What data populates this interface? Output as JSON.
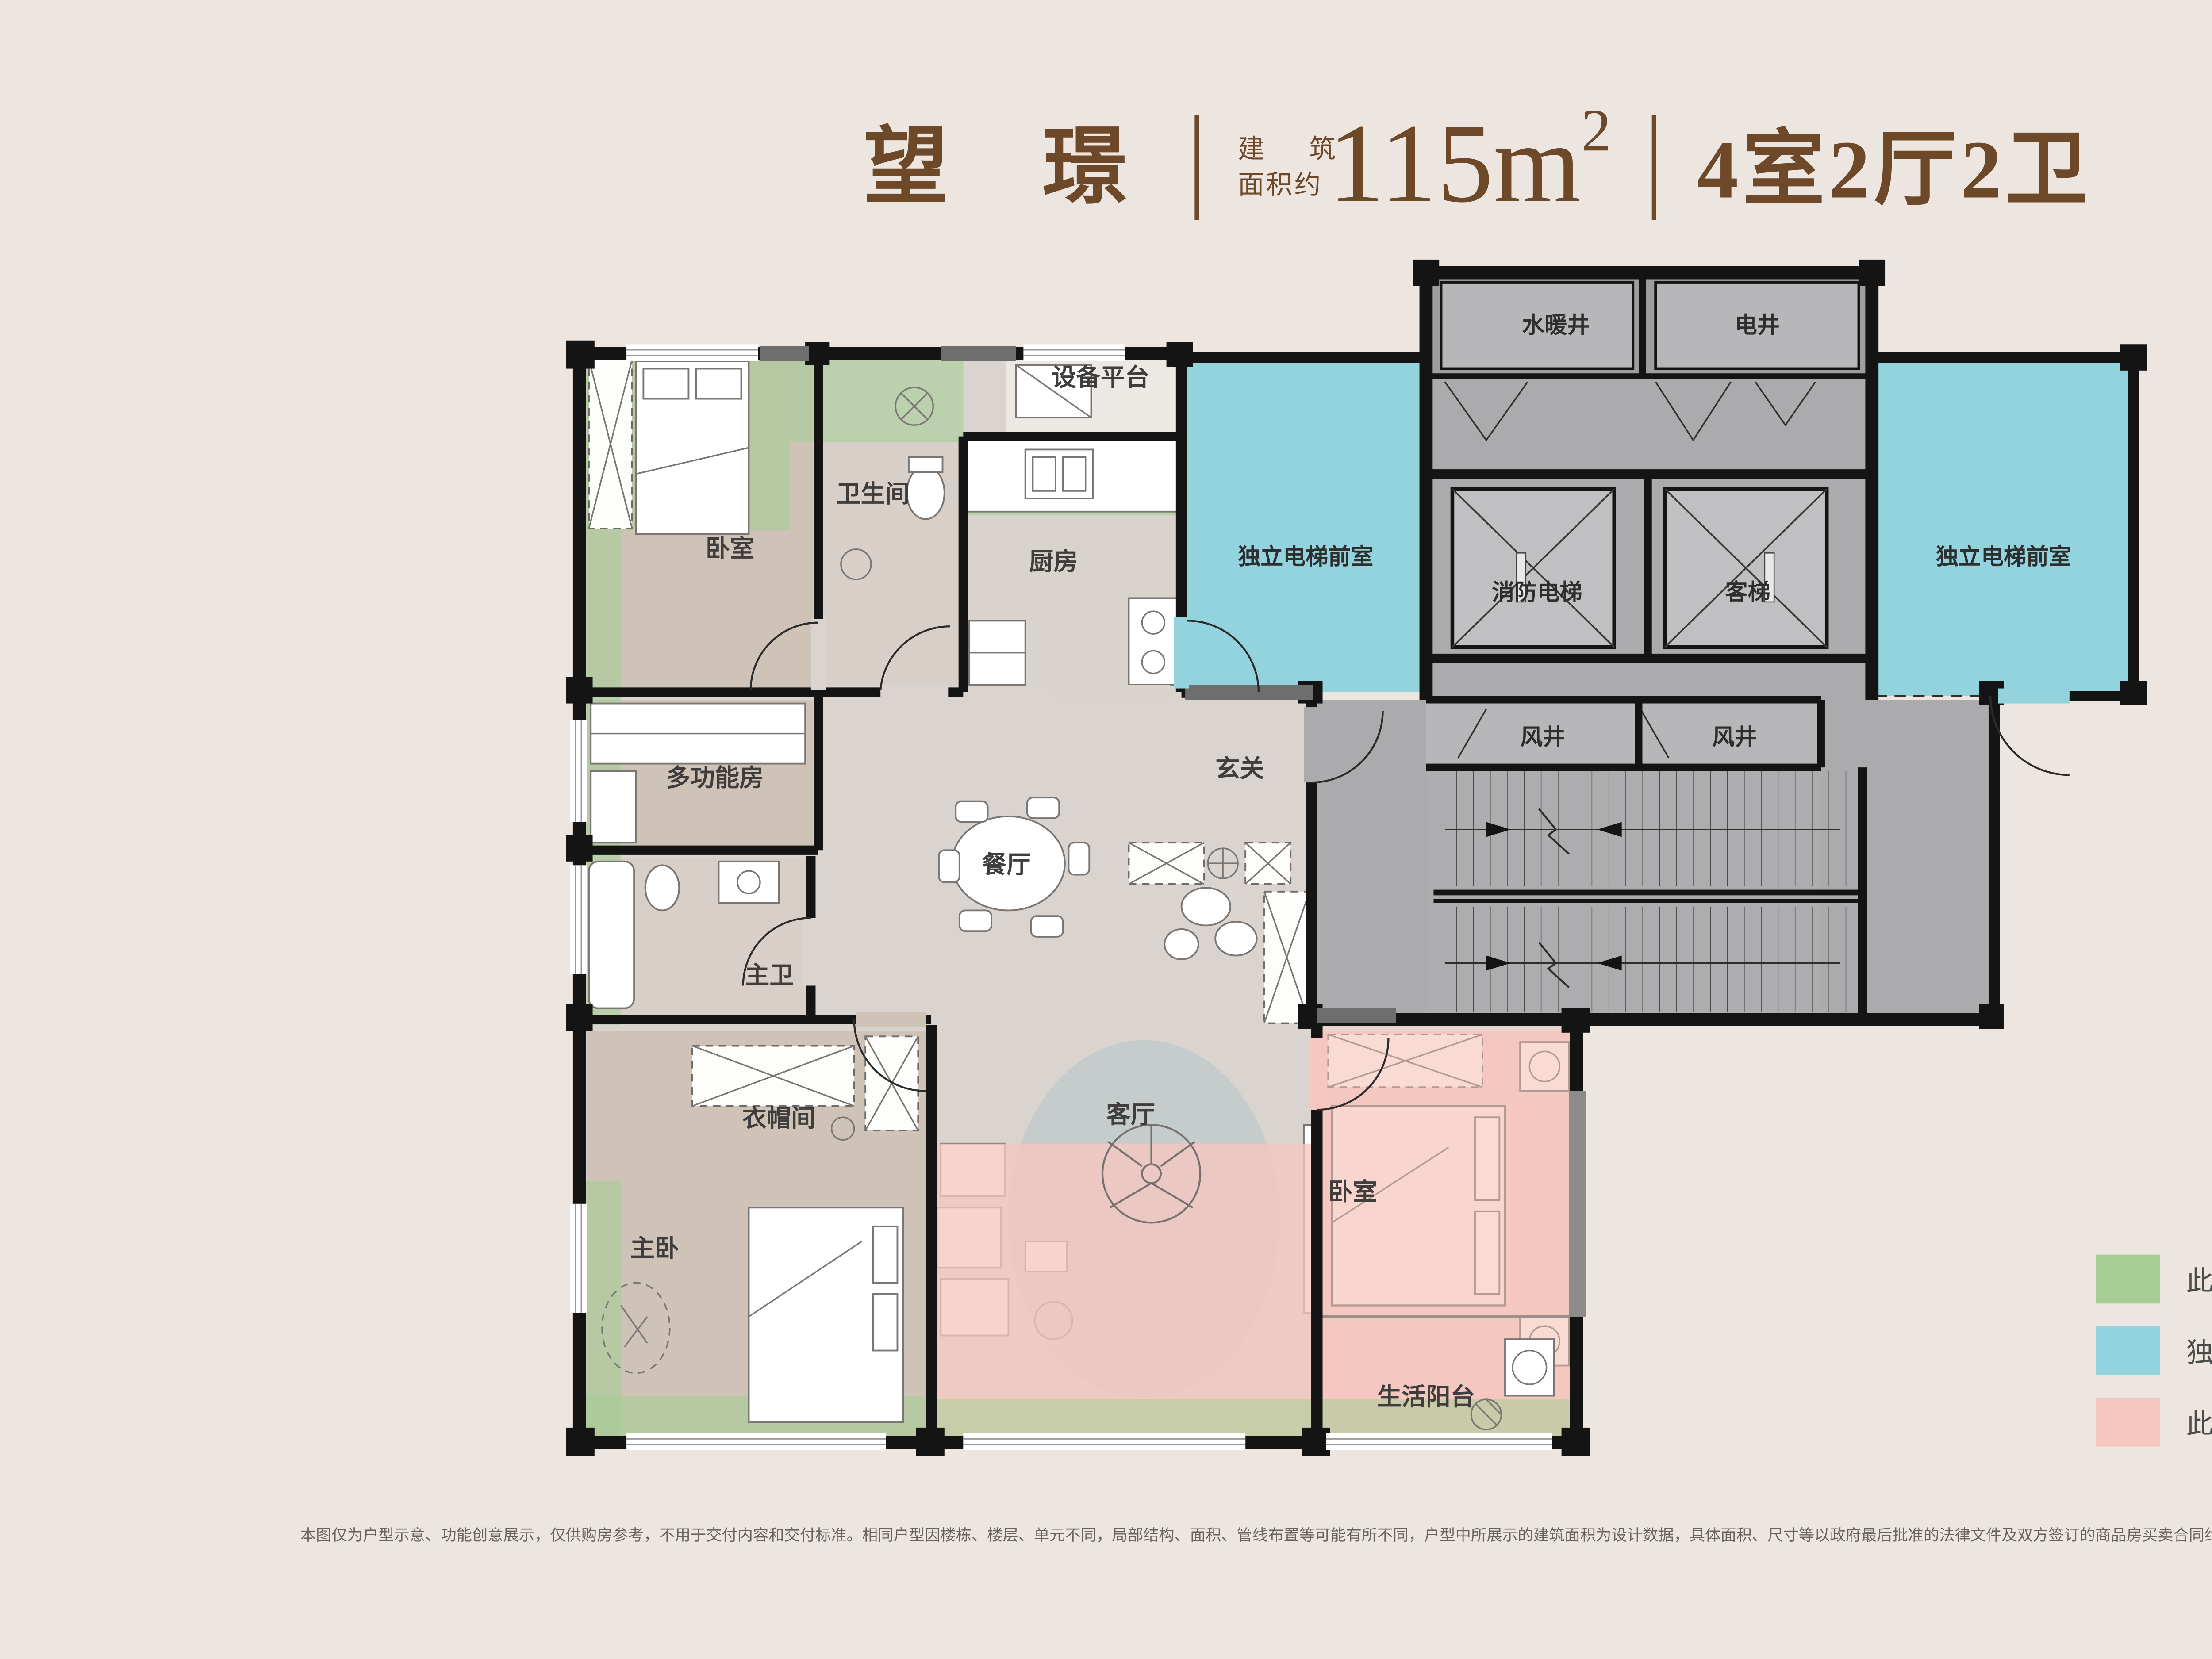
{
  "header": {
    "project_name": "望璟",
    "area_label_line1": "建 筑",
    "area_label_line2": "面积约",
    "area_number": "115m",
    "area_superscript": "2",
    "unit_spec": "4室2厅2卫"
  },
  "colors": {
    "accent": "#6D4829",
    "background": "#EDE5E0",
    "wall": "#141414",
    "green": "#A6CD94",
    "blue": "#92D3DD",
    "pink": "#F5C7BF",
    "core_gray": "#ABAAAC",
    "label": "#3F3E3C"
  },
  "floorplan": {
    "rooms": [
      {
        "id": "bedroom-top-left",
        "label": "卧室"
      },
      {
        "id": "bathroom",
        "label": "卫生间"
      },
      {
        "id": "equipment-platform",
        "label": "设备平台"
      },
      {
        "id": "kitchen",
        "label": "厨房"
      },
      {
        "id": "elevator-lobby-left",
        "label": "独立电梯前室"
      },
      {
        "id": "water-heating-shaft",
        "label": "水暖井"
      },
      {
        "id": "electrical-shaft",
        "label": "电井"
      },
      {
        "id": "fire-elevator",
        "label": "消防电梯"
      },
      {
        "id": "passenger-elevator",
        "label": "客梯"
      },
      {
        "id": "elevator-lobby-right",
        "label": "独立电梯前室"
      },
      {
        "id": "wind-shaft-a",
        "label": "风井"
      },
      {
        "id": "wind-shaft-b",
        "label": "风井"
      },
      {
        "id": "foyer",
        "label": "玄关"
      },
      {
        "id": "dining-room",
        "label": "餐厅"
      },
      {
        "id": "multifunction-room",
        "label": "多功能房"
      },
      {
        "id": "master-bathroom",
        "label": "主卫"
      },
      {
        "id": "cloakroom",
        "label": "衣帽间"
      },
      {
        "id": "master-bedroom",
        "label": "主卧"
      },
      {
        "id": "living-room",
        "label": "客厅"
      },
      {
        "id": "bedroom-right",
        "label": "卧室"
      },
      {
        "id": "balcony",
        "label": "生活阳台"
      }
    ]
  },
  "legend": {
    "items": [
      {
        "color": "#A6CD94",
        "label": "此区域 100% 不计入产权面积"
      },
      {
        "color": "#92D3DD",
        "label": "独立电梯前室"
      },
      {
        "color": "#F5C7BF",
        "label": "此区域 50% 不计入产权面积"
      }
    ]
  },
  "disclaimer": {
    "text": "本图仅为户型示意、功能创意展示，仅供购房参考，不用于交付内容和交付标准。相同户型因楼栋、楼层、单元不同，局部结构、面积、管线布置等可能有所不同，户型中所展示的建筑面积为设计数据，具体面积、尺寸等以政府最后批准的法律文件及双方签订的商品房买卖合同约定为准。本公司保留对户型图修改的权利，敬请留意最新资料。"
  }
}
